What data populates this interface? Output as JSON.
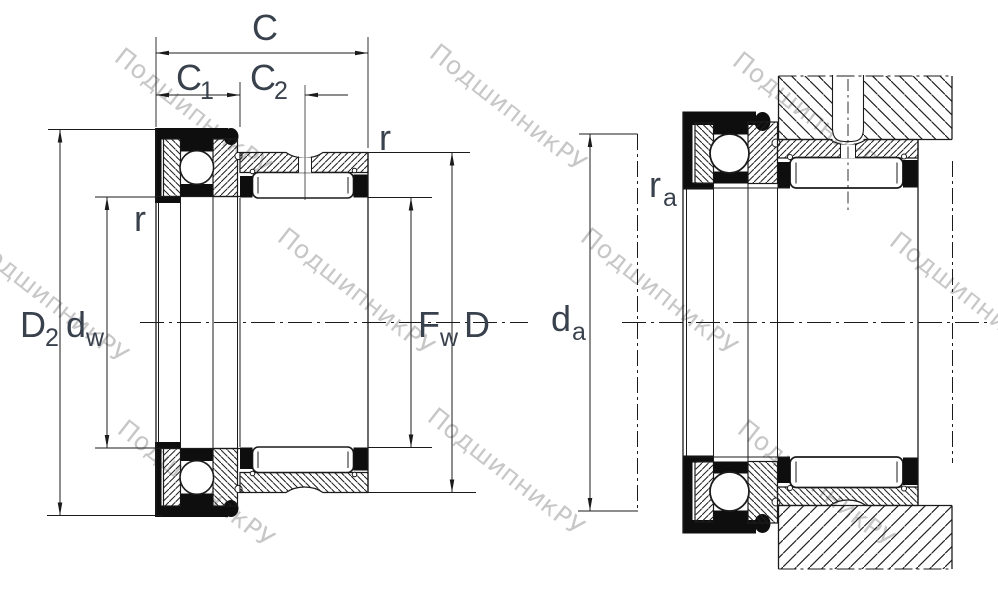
{
  "drawing": {
    "type": "bearing-technical-drawing",
    "description": "Combined needle roller / thrust ball bearing cross-section (left: free bearing with boundary dimensions, right: mounted arrangement)"
  },
  "watermark": {
    "text": "ПодшипникРУ",
    "color": "#c7c7c7"
  },
  "colors": {
    "line": "#1b1b1b",
    "seal": "#0e0e0e",
    "label": "#39414d",
    "background": "#ffffff"
  },
  "left_view": {
    "dim_c": {
      "base": "C"
    },
    "dim_c1": {
      "base": "C",
      "sub": "1"
    },
    "dim_c2": {
      "base": "C",
      "sub": "2"
    },
    "dim_r_right": {
      "base": "r"
    },
    "dim_r_left": {
      "base": "r"
    },
    "dim_d2": {
      "base": "D",
      "sub": "2"
    },
    "dim_dw": {
      "base": "d",
      "sub": "w"
    },
    "dim_fw": {
      "base": "F",
      "sub": "w"
    },
    "dim_d": {
      "base": "D"
    }
  },
  "right_view": {
    "dim_ra": {
      "base": "r",
      "sub": "a"
    },
    "dim_da": {
      "base": "d",
      "sub": "a"
    }
  }
}
